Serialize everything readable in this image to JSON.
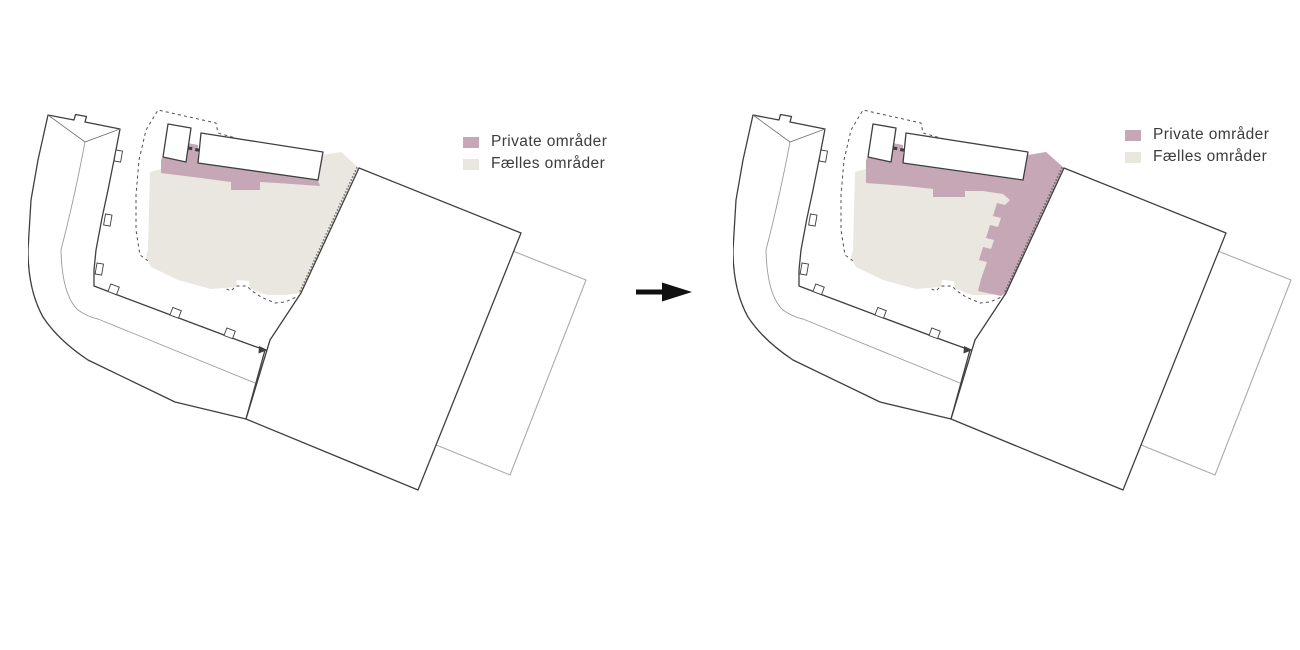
{
  "colors": {
    "private": "#c5a7b5",
    "common": "#eae6e0",
    "arrow": "#111111"
  },
  "legend": {
    "items": [
      {
        "label": "Private områder"
      },
      {
        "label": "Fælles områder"
      }
    ]
  }
}
